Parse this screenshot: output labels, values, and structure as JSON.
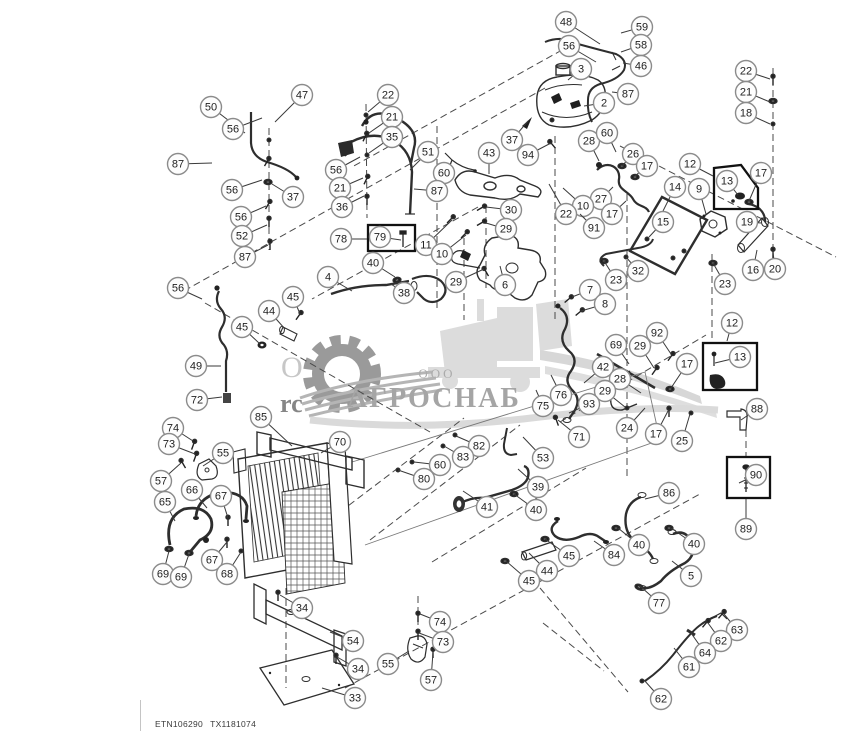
{
  "page": {
    "background": "#ffffff",
    "line_color": "#2e2e2e",
    "dash_color": "#4a4a4a"
  },
  "footer": {
    "doc_code": "ETN106290",
    "sheet_code": "TX1181074"
  },
  "watermark": {
    "company_prefix": "ООО",
    "company_name": "АГРОСНАБ",
    "fragment_letter": "О",
    "fragment_text": "rc",
    "gear_color": "#9a9a9a",
    "machine_color": "#dcdcdc",
    "text_color": "#a5a5a5"
  },
  "callout_style": {
    "radius": 10.5,
    "fill": "#fdfdfd",
    "stroke": "#8b8b8b",
    "text_color": "#222222",
    "leader_color": "#3a3a3a",
    "font_size": 11
  },
  "callouts": [
    {
      "n": "48",
      "x": 566,
      "y": 22,
      "lx": 600,
      "ly": 44
    },
    {
      "n": "59",
      "x": 642,
      "y": 27,
      "lx": 621,
      "ly": 33
    },
    {
      "n": "56",
      "x": 569,
      "y": 46,
      "lx": 596,
      "ly": 62
    },
    {
      "n": "58",
      "x": 641,
      "y": 45,
      "lx": 621,
      "ly": 52
    },
    {
      "n": "46",
      "x": 641,
      "y": 66,
      "lx": 623,
      "ly": 63
    },
    {
      "n": "3",
      "x": 581,
      "y": 69,
      "lx": 568,
      "ly": 80
    },
    {
      "n": "2",
      "x": 604,
      "y": 103,
      "lx": 584,
      "ly": 106
    },
    {
      "n": "87",
      "x": 628,
      "y": 94,
      "lx": 612,
      "ly": 92
    },
    {
      "n": "22",
      "x": 746,
      "y": 71,
      "lx": 770,
      "ly": 79
    },
    {
      "n": "21",
      "x": 746,
      "y": 92,
      "lx": 770,
      "ly": 102
    },
    {
      "n": "18",
      "x": 746,
      "y": 113,
      "lx": 770,
      "ly": 124
    },
    {
      "n": "50",
      "x": 211,
      "y": 107,
      "lx": 245,
      "ly": 133
    },
    {
      "n": "47",
      "x": 302,
      "y": 95,
      "lx": 275,
      "ly": 122
    },
    {
      "n": "56",
      "x": 233,
      "y": 129,
      "lx": 262,
      "ly": 118
    },
    {
      "n": "87",
      "x": 178,
      "y": 164,
      "lx": 212,
      "ly": 163
    },
    {
      "n": "56",
      "x": 232,
      "y": 190,
      "lx": 262,
      "ly": 180
    },
    {
      "n": "37",
      "x": 293,
      "y": 197,
      "lx": 272,
      "ly": 184
    },
    {
      "n": "56",
      "x": 241,
      "y": 217,
      "lx": 266,
      "ly": 206
    },
    {
      "n": "52",
      "x": 242,
      "y": 236,
      "lx": 267,
      "ly": 225
    },
    {
      "n": "87",
      "x": 245,
      "y": 257,
      "lx": 268,
      "ly": 245
    },
    {
      "n": "22",
      "x": 388,
      "y": 95,
      "lx": 368,
      "ly": 112
    },
    {
      "n": "21",
      "x": 392,
      "y": 117,
      "lx": 369,
      "ly": 133
    },
    {
      "n": "35",
      "x": 392,
      "y": 137,
      "lx": 369,
      "ly": 153
    },
    {
      "n": "51",
      "x": 428,
      "y": 152,
      "lx": 410,
      "ly": 170
    },
    {
      "n": "56",
      "x": 336,
      "y": 170,
      "lx": 360,
      "ly": 157
    },
    {
      "n": "21",
      "x": 340,
      "y": 188,
      "lx": 363,
      "ly": 178
    },
    {
      "n": "36",
      "x": 342,
      "y": 207,
      "lx": 364,
      "ly": 196
    },
    {
      "n": "60",
      "x": 444,
      "y": 173,
      "lx": 432,
      "ly": 190
    },
    {
      "n": "87",
      "x": 437,
      "y": 191,
      "lx": 414,
      "ly": 189
    },
    {
      "n": "43",
      "x": 489,
      "y": 153,
      "lx": 489,
      "ly": 174
    },
    {
      "n": "94",
      "x": 528,
      "y": 155,
      "lx": 551,
      "ly": 143
    },
    {
      "n": "37",
      "x": 512,
      "y": 140,
      "lx": 528,
      "ly": 121
    },
    {
      "n": "28",
      "x": 589,
      "y": 141,
      "lx": 599,
      "ly": 161
    },
    {
      "n": "60",
      "x": 607,
      "y": 133,
      "lx": 616,
      "ly": 152
    },
    {
      "n": "26",
      "x": 633,
      "y": 154,
      "lx": 622,
      "ly": 166
    },
    {
      "n": "17",
      "x": 647,
      "y": 166,
      "lx": 635,
      "ly": 176
    },
    {
      "n": "27",
      "x": 601,
      "y": 199,
      "lx": 613,
      "ly": 187
    },
    {
      "n": "10",
      "x": 583,
      "y": 206,
      "lx": 563,
      "ly": 188
    },
    {
      "n": "22",
      "x": 566,
      "y": 214,
      "lx": 549,
      "ly": 184
    },
    {
      "n": "17",
      "x": 612,
      "y": 214,
      "lx": 626,
      "ly": 201
    },
    {
      "n": "91",
      "x": 594,
      "y": 228,
      "lx": 580,
      "ly": 214
    },
    {
      "n": "14",
      "x": 675,
      "y": 187,
      "lx": 663,
      "ly": 211
    },
    {
      "n": "9",
      "x": 699,
      "y": 189,
      "lx": 706,
      "ly": 214
    },
    {
      "n": "15",
      "x": 663,
      "y": 222,
      "lx": 649,
      "ly": 237
    },
    {
      "n": "19",
      "x": 747,
      "y": 222,
      "lx": 761,
      "ly": 223
    },
    {
      "n": "12",
      "x": 690,
      "y": 164,
      "lx": 713,
      "ly": 176
    },
    {
      "n": "13",
      "x": 727,
      "y": 181,
      "lx": 738,
      "ly": 195
    },
    {
      "n": "17",
      "x": 761,
      "y": 173,
      "lx": 749,
      "ly": 201
    },
    {
      "n": "16",
      "x": 753,
      "y": 270,
      "lx": 757,
      "ly": 250
    },
    {
      "n": "20",
      "x": 775,
      "y": 269,
      "lx": 773,
      "ly": 252
    },
    {
      "n": "23",
      "x": 725,
      "y": 284,
      "lx": 713,
      "ly": 263
    },
    {
      "n": "23",
      "x": 616,
      "y": 280,
      "lx": 604,
      "ly": 261
    },
    {
      "n": "32",
      "x": 638,
      "y": 271,
      "lx": 626,
      "ly": 257
    },
    {
      "n": "7",
      "x": 590,
      "y": 290,
      "lx": 572,
      "ly": 297
    },
    {
      "n": "8",
      "x": 605,
      "y": 304,
      "lx": 581,
      "ly": 311
    },
    {
      "n": "78",
      "x": 341,
      "y": 239,
      "lx": 367,
      "ly": 239
    },
    {
      "n": "79",
      "x": 380,
      "y": 237,
      "lx": 401,
      "ly": 240
    },
    {
      "n": "11",
      "x": 426,
      "y": 245,
      "lx": 452,
      "ly": 220
    },
    {
      "n": "10",
      "x": 442,
      "y": 254,
      "lx": 466,
      "ly": 235
    },
    {
      "n": "30",
      "x": 511,
      "y": 210,
      "lx": 486,
      "ly": 207
    },
    {
      "n": "29",
      "x": 506,
      "y": 229,
      "lx": 486,
      "ly": 223
    },
    {
      "n": "40",
      "x": 373,
      "y": 263,
      "lx": 395,
      "ly": 277
    },
    {
      "n": "4",
      "x": 328,
      "y": 277,
      "lx": 352,
      "ly": 291
    },
    {
      "n": "38",
      "x": 404,
      "y": 293,
      "lx": 391,
      "ly": 284
    },
    {
      "n": "29",
      "x": 456,
      "y": 282,
      "lx": 484,
      "ly": 269
    },
    {
      "n": "6",
      "x": 505,
      "y": 285,
      "lx": 500,
      "ly": 266
    },
    {
      "n": "56",
      "x": 178,
      "y": 288,
      "lx": 202,
      "ly": 299
    },
    {
      "n": "45",
      "x": 293,
      "y": 297,
      "lx": 300,
      "ly": 314
    },
    {
      "n": "44",
      "x": 269,
      "y": 311,
      "lx": 285,
      "ly": 329
    },
    {
      "n": "45",
      "x": 242,
      "y": 327,
      "lx": 260,
      "ly": 344
    },
    {
      "n": "49",
      "x": 196,
      "y": 366,
      "lx": 221,
      "ly": 366
    },
    {
      "n": "72",
      "x": 197,
      "y": 400,
      "lx": 222,
      "ly": 397
    },
    {
      "n": "85",
      "x": 261,
      "y": 417,
      "lx": 292,
      "ly": 446
    },
    {
      "n": "70",
      "x": 340,
      "y": 442,
      "lx": 321,
      "ly": 453
    },
    {
      "n": "74",
      "x": 173,
      "y": 428,
      "lx": 193,
      "ly": 441
    },
    {
      "n": "73",
      "x": 169,
      "y": 444,
      "lx": 195,
      "ly": 454
    },
    {
      "n": "55",
      "x": 223,
      "y": 453,
      "lx": 203,
      "ly": 466
    },
    {
      "n": "57",
      "x": 161,
      "y": 481,
      "lx": 181,
      "ly": 463
    },
    {
      "n": "66",
      "x": 192,
      "y": 490,
      "lx": 207,
      "ly": 508
    },
    {
      "n": "67",
      "x": 221,
      "y": 496,
      "lx": 228,
      "ly": 518
    },
    {
      "n": "65",
      "x": 165,
      "y": 502,
      "lx": 175,
      "ly": 521
    },
    {
      "n": "67",
      "x": 212,
      "y": 560,
      "lx": 227,
      "ly": 542
    },
    {
      "n": "68",
      "x": 227,
      "y": 574,
      "lx": 241,
      "ly": 552
    },
    {
      "n": "69",
      "x": 163,
      "y": 574,
      "lx": 169,
      "ly": 551
    },
    {
      "n": "69",
      "x": 181,
      "y": 577,
      "lx": 189,
      "ly": 554
    },
    {
      "n": "34",
      "x": 302,
      "y": 608,
      "lx": 280,
      "ly": 595
    },
    {
      "n": "54",
      "x": 353,
      "y": 641,
      "lx": 330,
      "ly": 632
    },
    {
      "n": "34",
      "x": 358,
      "y": 669,
      "lx": 337,
      "ly": 657
    },
    {
      "n": "33",
      "x": 355,
      "y": 698,
      "lx": 322,
      "ly": 688
    },
    {
      "n": "55",
      "x": 388,
      "y": 664,
      "lx": 409,
      "ly": 651
    },
    {
      "n": "74",
      "x": 440,
      "y": 622,
      "lx": 420,
      "ly": 614
    },
    {
      "n": "73",
      "x": 443,
      "y": 642,
      "lx": 419,
      "ly": 633
    },
    {
      "n": "57",
      "x": 431,
      "y": 680,
      "lx": 433,
      "ly": 652
    },
    {
      "n": "92",
      "x": 657,
      "y": 333,
      "lx": 671,
      "ly": 354
    },
    {
      "n": "69",
      "x": 616,
      "y": 345,
      "lx": 629,
      "ly": 364
    },
    {
      "n": "29",
      "x": 640,
      "y": 346,
      "lx": 654,
      "ly": 368
    },
    {
      "n": "17",
      "x": 687,
      "y": 364,
      "lx": 671,
      "ly": 388
    },
    {
      "n": "42",
      "x": 603,
      "y": 367,
      "lx": 584,
      "ly": 383
    },
    {
      "n": "28",
      "x": 620,
      "y": 379,
      "lx": 641,
      "ly": 393
    },
    {
      "n": "29",
      "x": 605,
      "y": 391,
      "lx": 625,
      "ly": 407
    },
    {
      "n": "76",
      "x": 561,
      "y": 395,
      "lx": 551,
      "ly": 375
    },
    {
      "n": "75",
      "x": 543,
      "y": 406,
      "lx": 536,
      "ly": 390
    },
    {
      "n": "93",
      "x": 589,
      "y": 404,
      "lx": 569,
      "ly": 413
    },
    {
      "n": "24",
      "x": 627,
      "y": 428,
      "lx": 645,
      "ly": 408
    },
    {
      "n": "17",
      "x": 656,
      "y": 434,
      "lx": 668,
      "ly": 411
    },
    {
      "n": "25",
      "x": 682,
      "y": 441,
      "lx": 690,
      "ly": 414
    },
    {
      "n": "71",
      "x": 579,
      "y": 437,
      "lx": 558,
      "ly": 420
    },
    {
      "n": "88",
      "x": 757,
      "y": 409,
      "lx": 741,
      "ly": 420
    },
    {
      "n": "12",
      "x": 732,
      "y": 323,
      "lx": 727,
      "ly": 341
    },
    {
      "n": "13",
      "x": 740,
      "y": 357,
      "lx": 715,
      "ly": 363
    },
    {
      "n": "90",
      "x": 756,
      "y": 475,
      "lx": 739,
      "ly": 483
    },
    {
      "n": "89",
      "x": 746,
      "y": 529,
      "lx": 746,
      "ly": 499
    },
    {
      "n": "53",
      "x": 543,
      "y": 458,
      "lx": 523,
      "ly": 437
    },
    {
      "n": "82",
      "x": 479,
      "y": 446,
      "lx": 456,
      "ly": 436
    },
    {
      "n": "83",
      "x": 463,
      "y": 457,
      "lx": 444,
      "ly": 446
    },
    {
      "n": "60",
      "x": 440,
      "y": 465,
      "lx": 414,
      "ly": 462
    },
    {
      "n": "80",
      "x": 424,
      "y": 479,
      "lx": 398,
      "ly": 470
    },
    {
      "n": "39",
      "x": 538,
      "y": 487,
      "lx": 518,
      "ly": 469
    },
    {
      "n": "41",
      "x": 487,
      "y": 507,
      "lx": 463,
      "ly": 491
    },
    {
      "n": "40",
      "x": 536,
      "y": 510,
      "lx": 514,
      "ly": 494
    },
    {
      "n": "45",
      "x": 569,
      "y": 556,
      "lx": 545,
      "ly": 539
    },
    {
      "n": "44",
      "x": 547,
      "y": 571,
      "lx": 529,
      "ly": 553
    },
    {
      "n": "45",
      "x": 529,
      "y": 581,
      "lx": 506,
      "ly": 561
    },
    {
      "n": "84",
      "x": 614,
      "y": 555,
      "lx": 594,
      "ly": 541
    },
    {
      "n": "86",
      "x": 669,
      "y": 493,
      "lx": 645,
      "ly": 499
    },
    {
      "n": "40",
      "x": 639,
      "y": 545,
      "lx": 618,
      "ly": 528
    },
    {
      "n": "40",
      "x": 694,
      "y": 544,
      "lx": 671,
      "ly": 528
    },
    {
      "n": "5",
      "x": 691,
      "y": 576,
      "lx": 672,
      "ly": 561
    },
    {
      "n": "77",
      "x": 659,
      "y": 603,
      "lx": 640,
      "ly": 586
    },
    {
      "n": "63",
      "x": 737,
      "y": 630,
      "lx": 724,
      "ly": 614
    },
    {
      "n": "62",
      "x": 721,
      "y": 641,
      "lx": 708,
      "ly": 623
    },
    {
      "n": "64",
      "x": 705,
      "y": 653,
      "lx": 691,
      "ly": 633
    },
    {
      "n": "61",
      "x": 689,
      "y": 667,
      "lx": 674,
      "ly": 648
    },
    {
      "n": "62",
      "x": 661,
      "y": 699,
      "lx": 644,
      "ly": 680
    }
  ]
}
